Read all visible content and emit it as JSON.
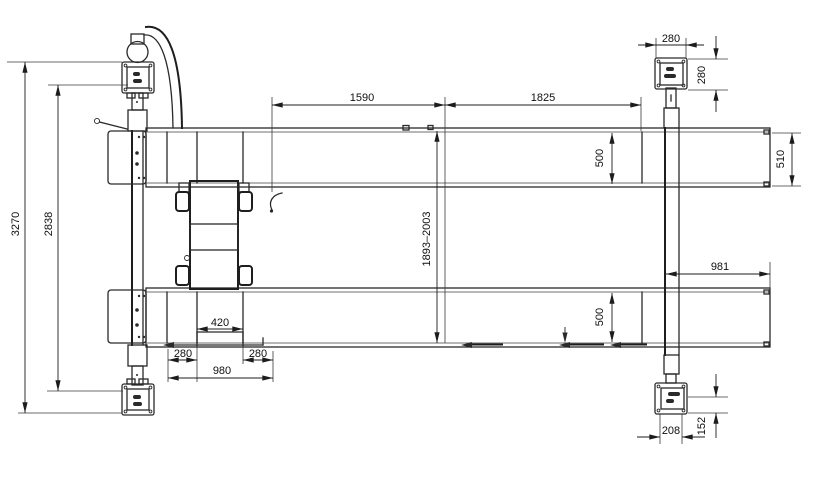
{
  "drawing": {
    "type": "technical-plan-view-four-post-lift",
    "background": "#ffffff",
    "line_color": "#2a2a2a",
    "dims": {
      "total_length": "3270",
      "inner_length": "2838",
      "seg_left": "1590",
      "seg_right": "1825",
      "spacing_range": "1893–2003",
      "plate_w": "280",
      "plate_d": "280",
      "ext_width": "510",
      "runway_w_top": "500",
      "runway_w_bot": "500",
      "overhang": "981",
      "jack_w": "420",
      "off_l": "280",
      "off_r": "280",
      "base_span": "980",
      "anchor_w": "208",
      "anchor_off": "152"
    }
  }
}
